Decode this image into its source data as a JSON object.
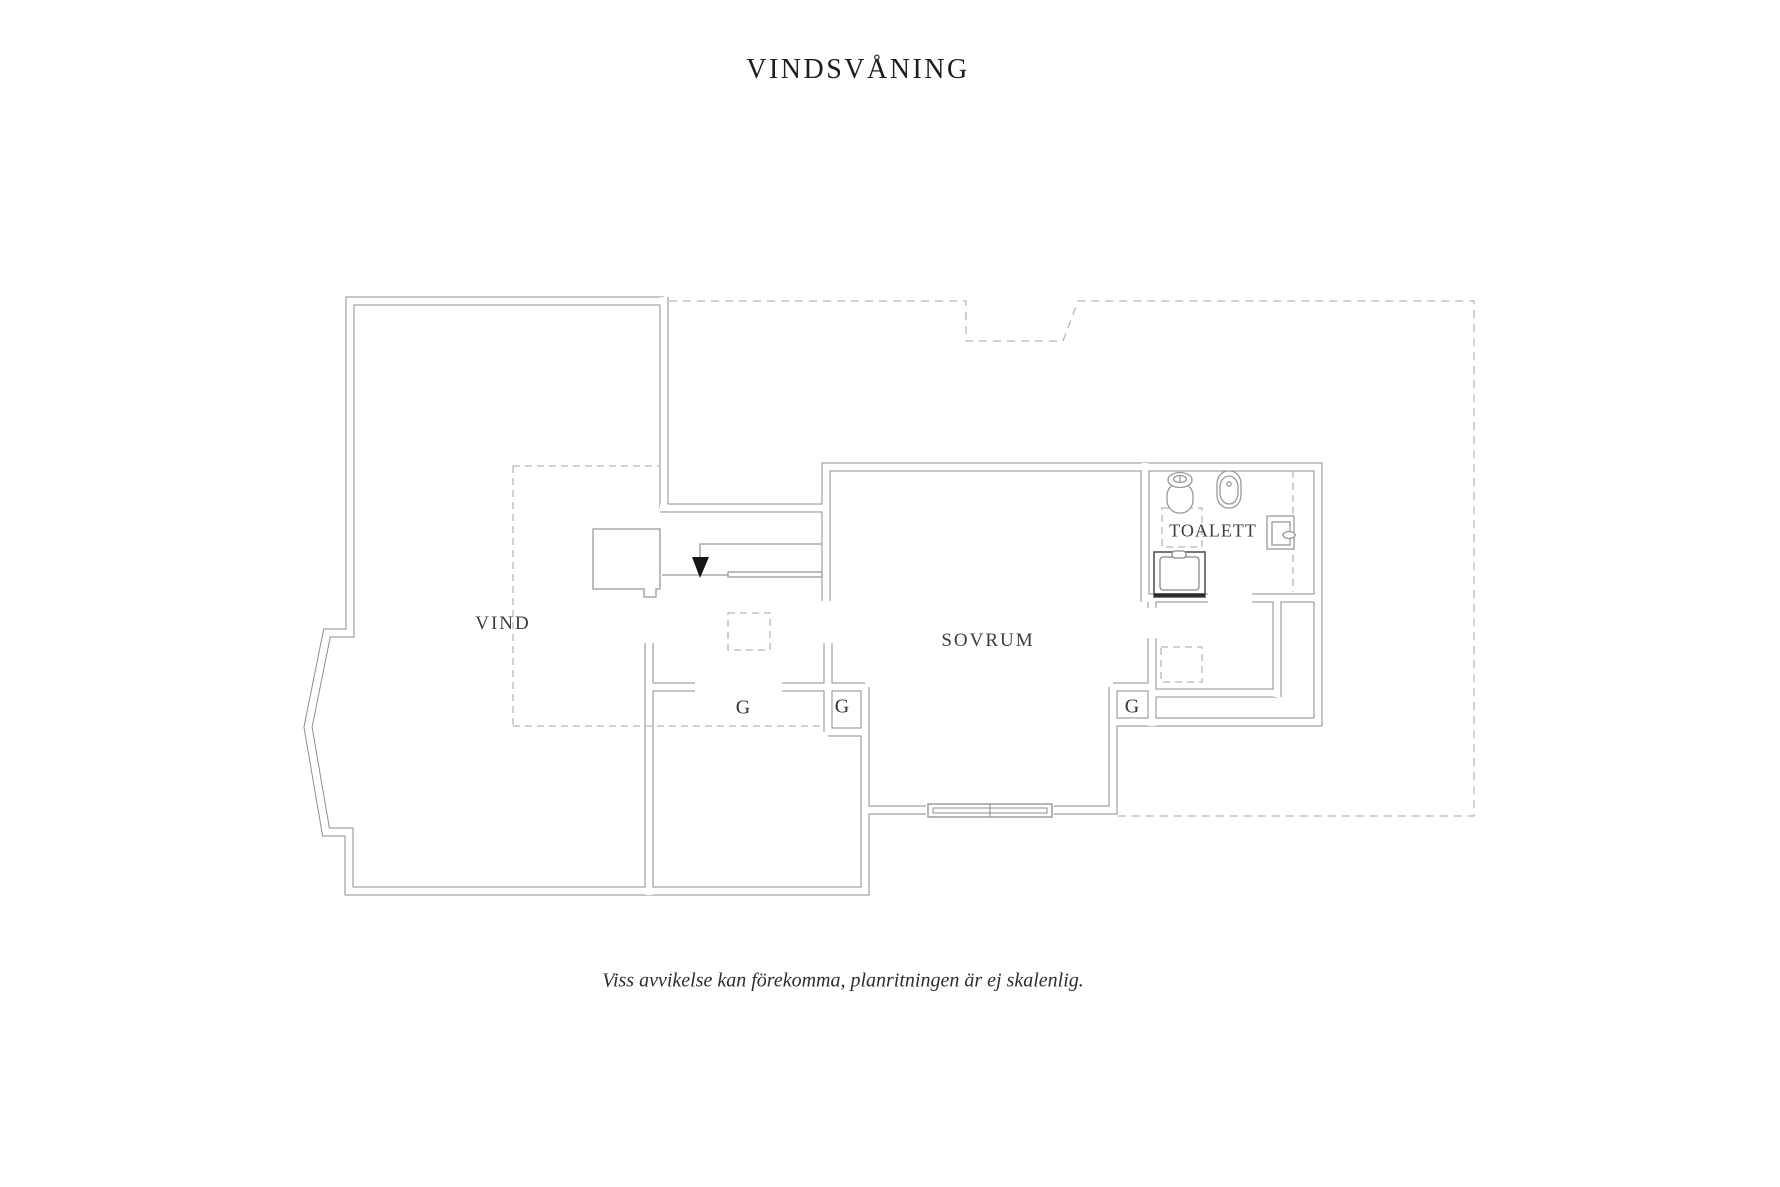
{
  "title": "VINDSVÅNING",
  "disclaimer": "Viss avvikelse kan förekomma, planritningen är ej skalenlig.",
  "rooms": {
    "attic": "VIND",
    "bedroom": "SOVRUM",
    "toilet": "TOALETT"
  },
  "closets": {
    "g1": "G",
    "g2": "G",
    "g3": "G"
  },
  "colors": {
    "background": "#ffffff",
    "wall_line": "#8e8e8e",
    "thin_line": "#9a9a9a",
    "dashed_line": "#b8b8b8",
    "fixture_line": "#999999",
    "appliance_dark": "#3a3a3a",
    "stair_arrow": "#161616",
    "title_text": "#1d1d1d",
    "room_text": "#3c3c3c",
    "disclaimer_text": "#2e2e2e"
  }
}
